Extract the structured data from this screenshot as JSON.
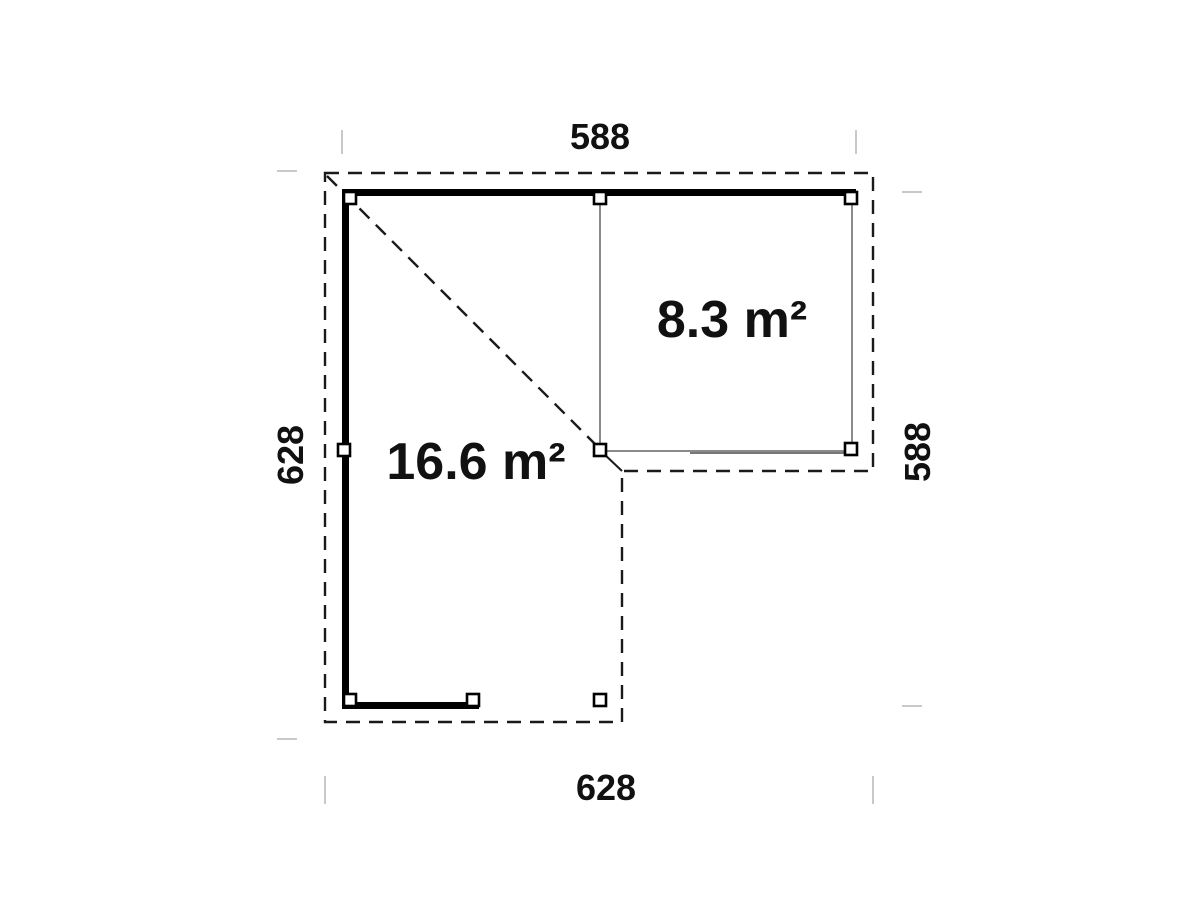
{
  "floor_plan": {
    "title": "L-shaped corner building floor plan",
    "rooms": [
      {
        "id": "open-carport-area",
        "area_label": "16.6 m²"
      },
      {
        "id": "enclosed-room",
        "area_label": "8.3 m²"
      }
    ],
    "dimensions": {
      "top_width": "588",
      "bottom_width": "628",
      "left_height": "628",
      "right_height": "588"
    },
    "colors": {
      "wall": "#000000",
      "outline": "#1a1a1a",
      "thin_wall": "#8a8a8a",
      "thin_wall_dark": "#777777",
      "tick": "#c9c9c9",
      "text": "#111111",
      "background": "#ffffff"
    }
  }
}
